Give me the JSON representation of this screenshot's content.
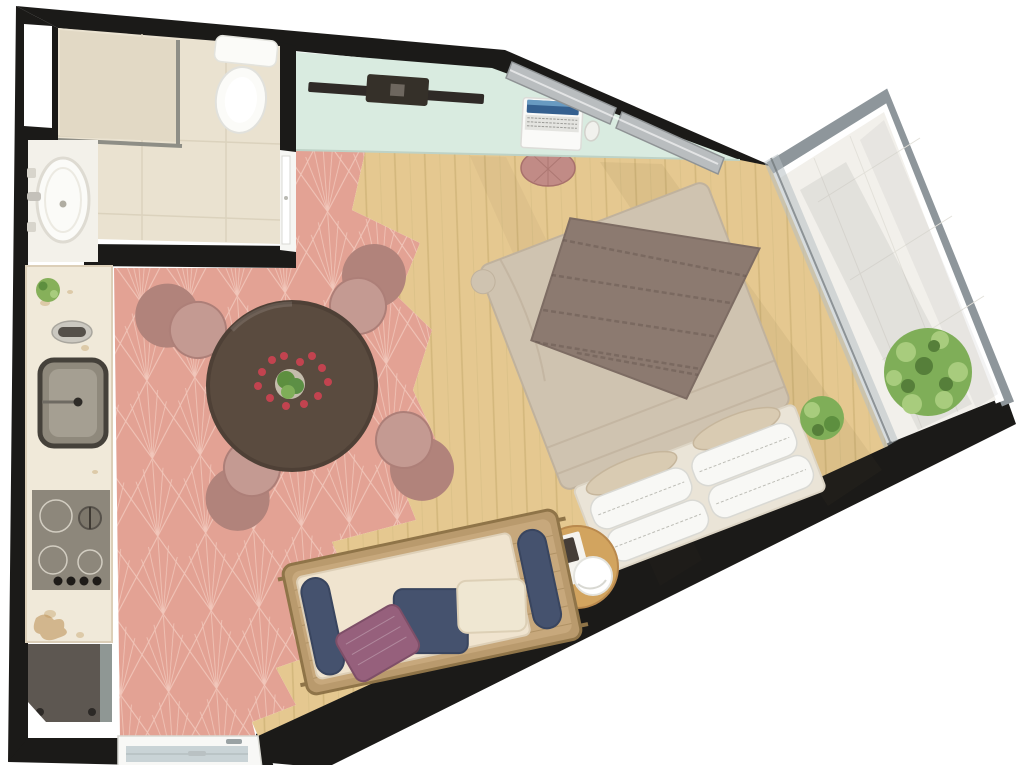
{
  "plan": {
    "kind": "studio-apartment-floor-plan-render",
    "view": "top-down-3d",
    "rooms": [
      {
        "id": "bathroom",
        "items": [
          "shower",
          "toilet",
          "bathtub-vanity",
          "window",
          "door"
        ]
      },
      {
        "id": "kitchen",
        "items": [
          "marble-counter",
          "potted-plant",
          "faucet",
          "square-sink",
          "cooktop",
          "appliance"
        ]
      },
      {
        "id": "dining-area",
        "items": [
          "round-table",
          "chair",
          "chair",
          "chair",
          "chair",
          "flower-centerpiece"
        ]
      },
      {
        "id": "living-sleeping-area",
        "items": [
          "wall-desk",
          "tv-console",
          "laptop",
          "mouse",
          "stool",
          "double-bed",
          "knit-throw",
          "pillows",
          "daybed-sofa",
          "side-table",
          "sphere-lamp",
          "plant"
        ]
      },
      {
        "id": "balcony",
        "items": [
          "glass-partition",
          "bush-plant",
          "tile-floor"
        ]
      },
      {
        "id": "entrance",
        "items": [
          "front-door"
        ]
      }
    ],
    "counts": {
      "dining_chairs": 4,
      "white_pillows": 4,
      "sofa_pillows": 3
    }
  },
  "colors": {
    "bg": "#ffffff",
    "wall": "#1b1a18",
    "bathroom_tile": "#eae2d0",
    "shower": "#e2d9c5",
    "fixture": "#fbfbf8",
    "marble": "#f0e9d9",
    "sink": "#8f897c",
    "sink_inner": "#a59f92",
    "cooktop": "#8d877b",
    "appliance": "#5d5751",
    "pink_floor": "#e3a294",
    "pink_line": "#f7d6ca",
    "wood": "#e5c890",
    "mint": "#d9ebe0",
    "table": "#5a4b3f",
    "chair": "#c49a92",
    "chair_back": "#b1837b",
    "duvet": "#cfc3b0",
    "throw": "#8c7a70",
    "platform": "#eae4d7",
    "pillow_white": "#f8f8f5",
    "pillow_beige": "#d9cbb2",
    "rattan": "#c7a87c",
    "frame_tan": "#b99a6d",
    "cushion": "#f0e4cf",
    "navy": "#45526e",
    "mauve": "#96607c",
    "cream": "#efe7d2",
    "side_table": "#d2a45f",
    "lamp": "#ffffff",
    "book": "#453d37",
    "balcony_floor": "#f2f0eb",
    "balcony_frame": "#8e969b",
    "glass": "#b7bfc2",
    "green": "#7fae58",
    "green_dark": "#5d8f3f",
    "red_flower": "#c2434f",
    "tv": "#2f2a27",
    "laptop_screen": "#35608f",
    "door_leaf": "#c9d3d6",
    "silver": "#b9bdbf",
    "stool": "#c18b86"
  }
}
